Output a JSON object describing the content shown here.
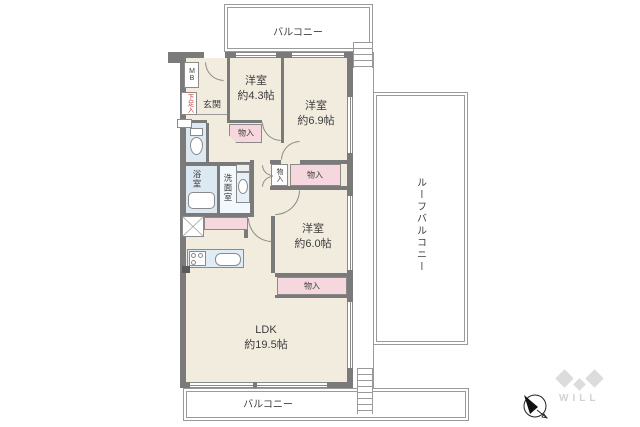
{
  "plan": {
    "outdoor": {
      "balcony_top_label": "バルコニー",
      "balcony_bottom_label": "バルコニー",
      "roof_balcony_label": "ルーフバルコニー"
    },
    "rooms": {
      "western1": {
        "name": "洋室",
        "size": "約4.3帖"
      },
      "western2": {
        "name": "洋室",
        "size": "約6.9帖"
      },
      "western3": {
        "name": "洋室",
        "size": "約6.0帖"
      },
      "ldk": {
        "name": "LDK",
        "size": "約19.5帖"
      },
      "entrance": "玄関",
      "bath": "浴室",
      "washroom": "洗面室"
    },
    "fixtures": {
      "closet": "物入",
      "shoe_cabinet": "下足入",
      "meter_box": "MB"
    },
    "compass_direction": "northwest",
    "branding": {
      "logo": "WILL"
    },
    "colors": {
      "wall": "#7a7a7a",
      "floor": "#f2ecdf",
      "closet_pink": "#f6d7de",
      "water_blue": "#dce8f2",
      "outline_gray": "#9a9a9a",
      "accent_red": "#cc3333",
      "logo_gray": "#d9d9d9"
    }
  }
}
